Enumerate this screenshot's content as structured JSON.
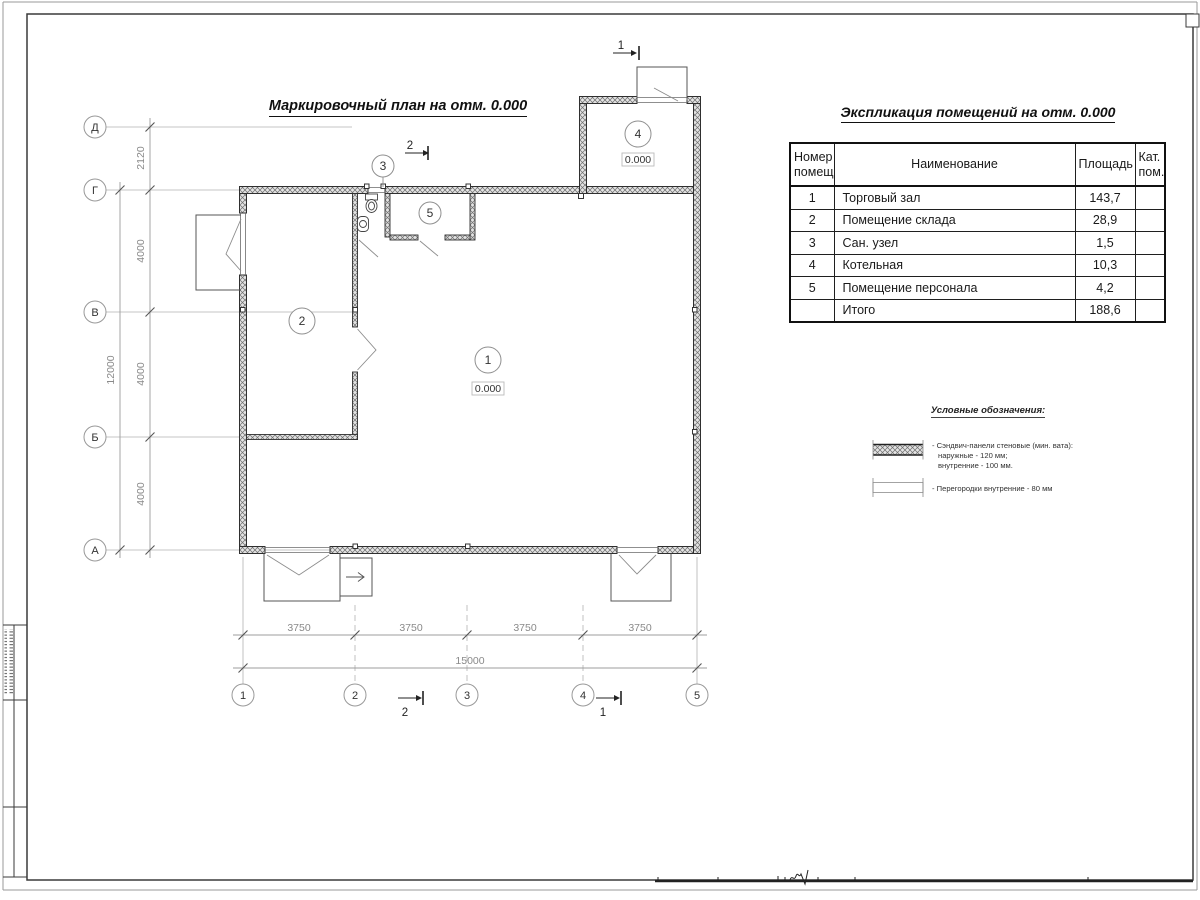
{
  "plan": {
    "title": "Маркировочный план на отм. 0.000",
    "level_mark": "0.000",
    "axes_vertical": [
      "Д",
      "Г",
      "В",
      "Б",
      "А"
    ],
    "axes_horizontal": [
      "1",
      "2",
      "3",
      "4",
      "5"
    ],
    "dims": {
      "left_segments": [
        "2120",
        "4000",
        "4000",
        "4000"
      ],
      "left_total": "12000",
      "bottom_segments": [
        "3750",
        "3750",
        "3750",
        "3750"
      ],
      "bottom_total": "15000"
    },
    "room_numbers": [
      "1",
      "2",
      "3",
      "4",
      "5"
    ],
    "section_marks": {
      "s1": "1",
      "s2": "2"
    }
  },
  "schedule": {
    "title": "Экспликация помещений на отм. 0.000",
    "columns": [
      "Номер помещ.",
      "Наименование",
      "Площадь",
      "Кат. пом."
    ],
    "rows": [
      [
        "1",
        "Торговый зал",
        "143,7",
        ""
      ],
      [
        "2",
        "Помещение склада",
        "28,9",
        ""
      ],
      [
        "3",
        "Сан. узел",
        "1,5",
        ""
      ],
      [
        "4",
        "Котельная",
        "10,3",
        ""
      ],
      [
        "5",
        "Помещение персонала",
        "4,2",
        ""
      ],
      [
        "",
        "Итого",
        "188,6",
        ""
      ]
    ]
  },
  "legend": {
    "title": "Условные обозначения:",
    "item1_lines": [
      "- Сэндвич-панели стеновые (мин. вата):",
      "наружные - 120 мм;",
      "внутренние - 100 мм."
    ],
    "item2_label": "- Перегородки внутренние - 80 мм"
  }
}
